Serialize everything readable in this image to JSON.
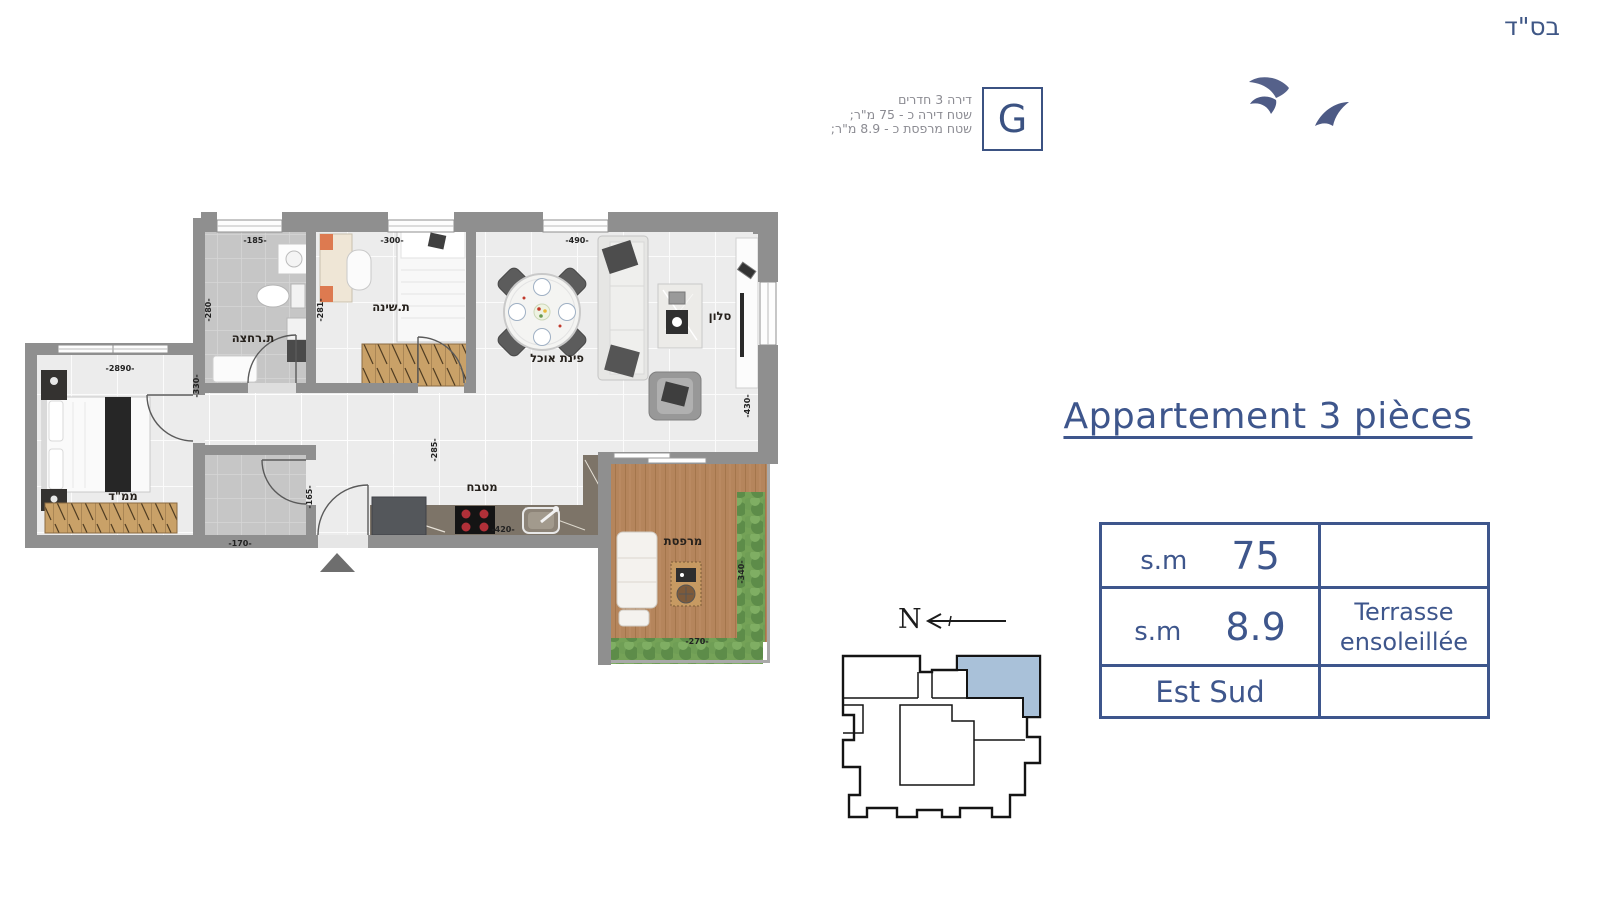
{
  "page": {
    "bsd": "בס\"ד"
  },
  "unit_info": {
    "line1": "דירה 3 חדרים",
    "line2": "שטח דירה כ - 75 מ\"ר;",
    "line3": "שטח מרפסת כ - 8.9 מ\"ר;",
    "unit_letter": "G"
  },
  "title": "Appartement 3 pièces",
  "spec_table": {
    "row1": {
      "unit": "s.m",
      "value": "75",
      "note": ""
    },
    "row2": {
      "unit": "s.m",
      "value": "8.9",
      "note_line1": "Terrasse",
      "note_line2": "ensoleillée"
    },
    "row3": {
      "orientation": "Est Sud",
      "note": ""
    }
  },
  "north": {
    "label": "N"
  },
  "floor_plan": {
    "rooms": {
      "bathroom": "ת.רחצה",
      "bedroom": "ת.שינה",
      "dining": "פינת אוכל",
      "salon": "סלון",
      "kitchen": "מטבח",
      "shelter_bedroom": "ממ\"ד",
      "balcony": "מרפסת"
    },
    "dimensions": {
      "bathroom_width": "-185-",
      "bathroom_depth": "-280-",
      "bedroom_width": "-300-",
      "bedroom_depth": "-281-",
      "living_width": "-490-",
      "salon_depth": "-430-",
      "hall_depth": "-285-",
      "kitchen_width": "-420-",
      "master_width": "-2890-",
      "master_side": "-330-",
      "wc_width": "-170-",
      "wc_depth": "-165-",
      "balcony_depth": "-340-",
      "balcony_width": "-270-"
    }
  },
  "colors": {
    "accent": "#3e568c",
    "keyplan_highlight": "#a9c1d9",
    "wall": "#8f8f8f"
  }
}
